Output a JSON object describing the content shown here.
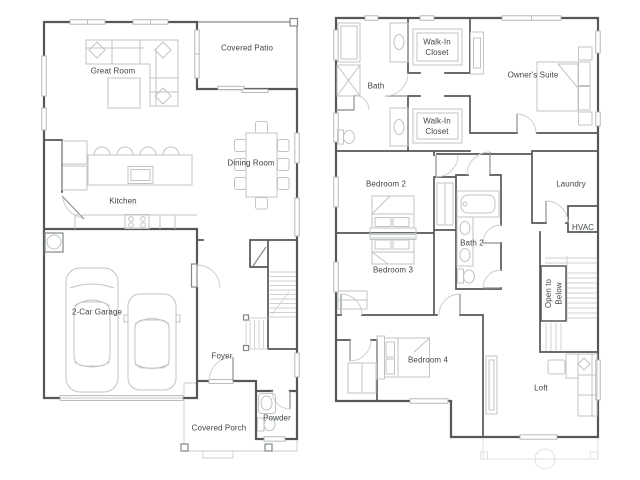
{
  "colors": {
    "background": "#ffffff",
    "walls": "#54585b",
    "furniture_outline": "#c0c4c6",
    "faint_outline": "#e0e2e3",
    "label_text": "#3f4548",
    "window_fill": "#ffffff"
  },
  "floor1": {
    "great_room": "Great Room",
    "covered_patio": "Covered Patio",
    "dining_room": "Dining Room",
    "kitchen": "Kitchen",
    "garage": "2-Car Garage",
    "foyer": "Foyer",
    "covered_porch": "Covered Porch",
    "powder": "Powder"
  },
  "floor2": {
    "bath": "Bath",
    "walk_in_closet_1": {
      "line1": "Walk-In",
      "line2": "Closet"
    },
    "walk_in_closet_2": {
      "line1": "Walk-In",
      "line2": "Closet"
    },
    "owners_suite": "Owner's Suite",
    "bedroom_2": "Bedroom 2",
    "laundry": "Laundry",
    "hvac": "HVAC",
    "bedroom_3": "Bedroom 3",
    "bath_2": "Bath 2",
    "open_to_below": {
      "line1": "Open to",
      "line2": "Below"
    },
    "bedroom_4": "Bedroom 4",
    "loft": "Loft"
  }
}
